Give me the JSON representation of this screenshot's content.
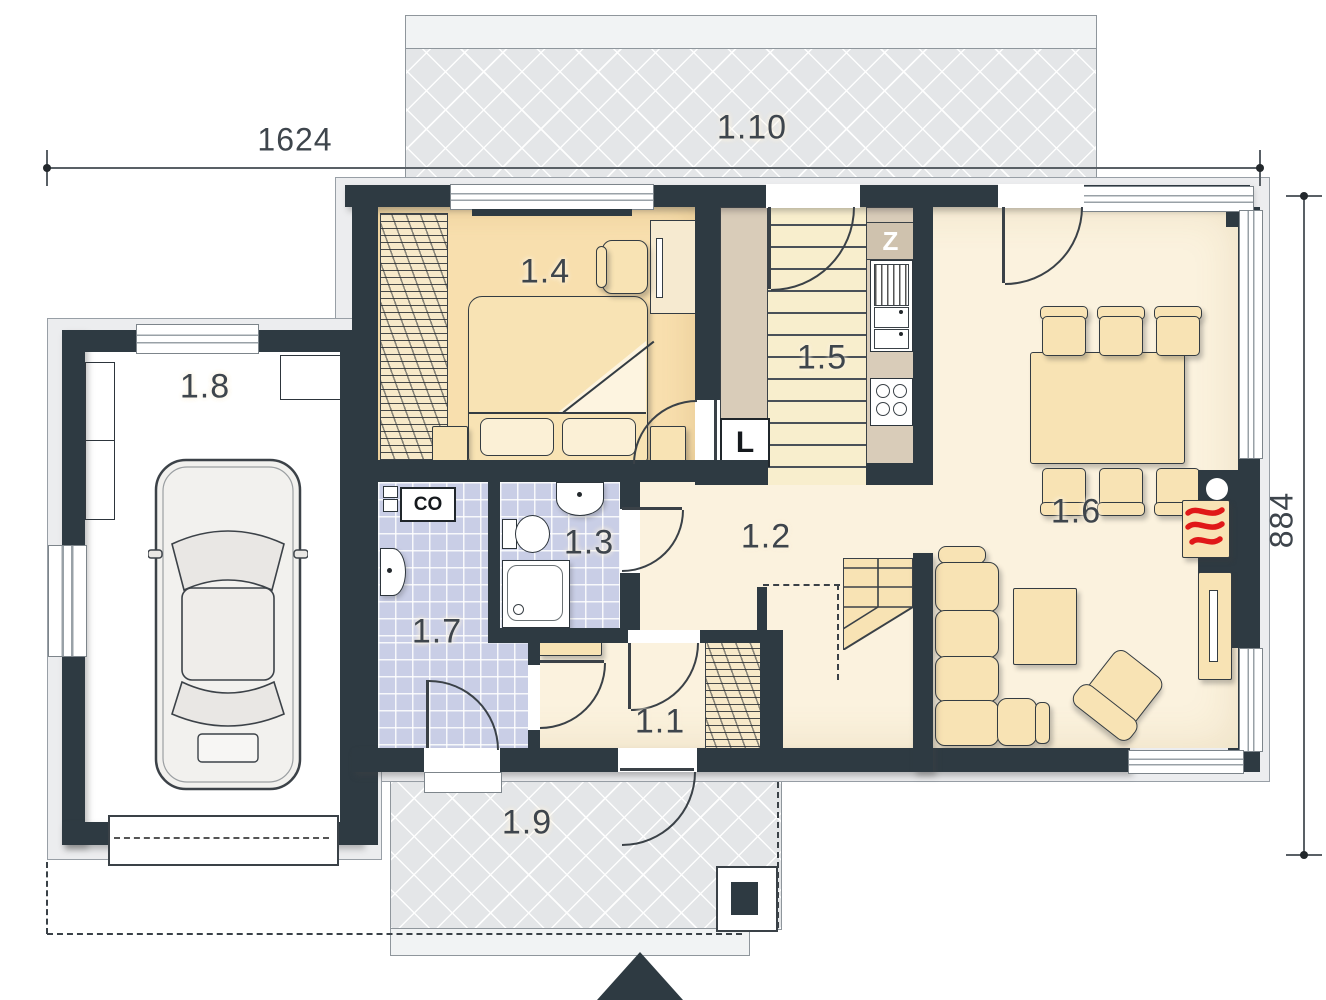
{
  "plan": {
    "type": "architectural-floor-plan",
    "floor": "ground-floor"
  },
  "dimensions": {
    "width_label": "1624",
    "height_label": "884"
  },
  "rooms": [
    {
      "number": "1.1",
      "name": "vestibule"
    },
    {
      "number": "1.2",
      "name": "hall"
    },
    {
      "number": "1.3",
      "name": "bathroom"
    },
    {
      "number": "1.4",
      "name": "bedroom"
    },
    {
      "number": "1.5",
      "name": "kitchen"
    },
    {
      "number": "1.6",
      "name": "living-dining-room"
    },
    {
      "number": "1.7",
      "name": "utility-boiler-room"
    },
    {
      "number": "1.8",
      "name": "garage"
    },
    {
      "number": "1.9",
      "name": "front-terrace"
    },
    {
      "number": "1.10",
      "name": "rear-terrace"
    }
  ],
  "markers": {
    "boiler": "CO",
    "fridge": "L",
    "sink": "Z"
  },
  "colors": {
    "wall": "#2e3a42",
    "floor_cream": "#fbf2de",
    "floor_bedroom": "#f8dfae",
    "kitchen_counter": "#d9ccb9",
    "tiles": "#c9cee6",
    "terrace": "#e4e6e8",
    "furniture": "#f8e3b4",
    "flames": "#e01818"
  }
}
